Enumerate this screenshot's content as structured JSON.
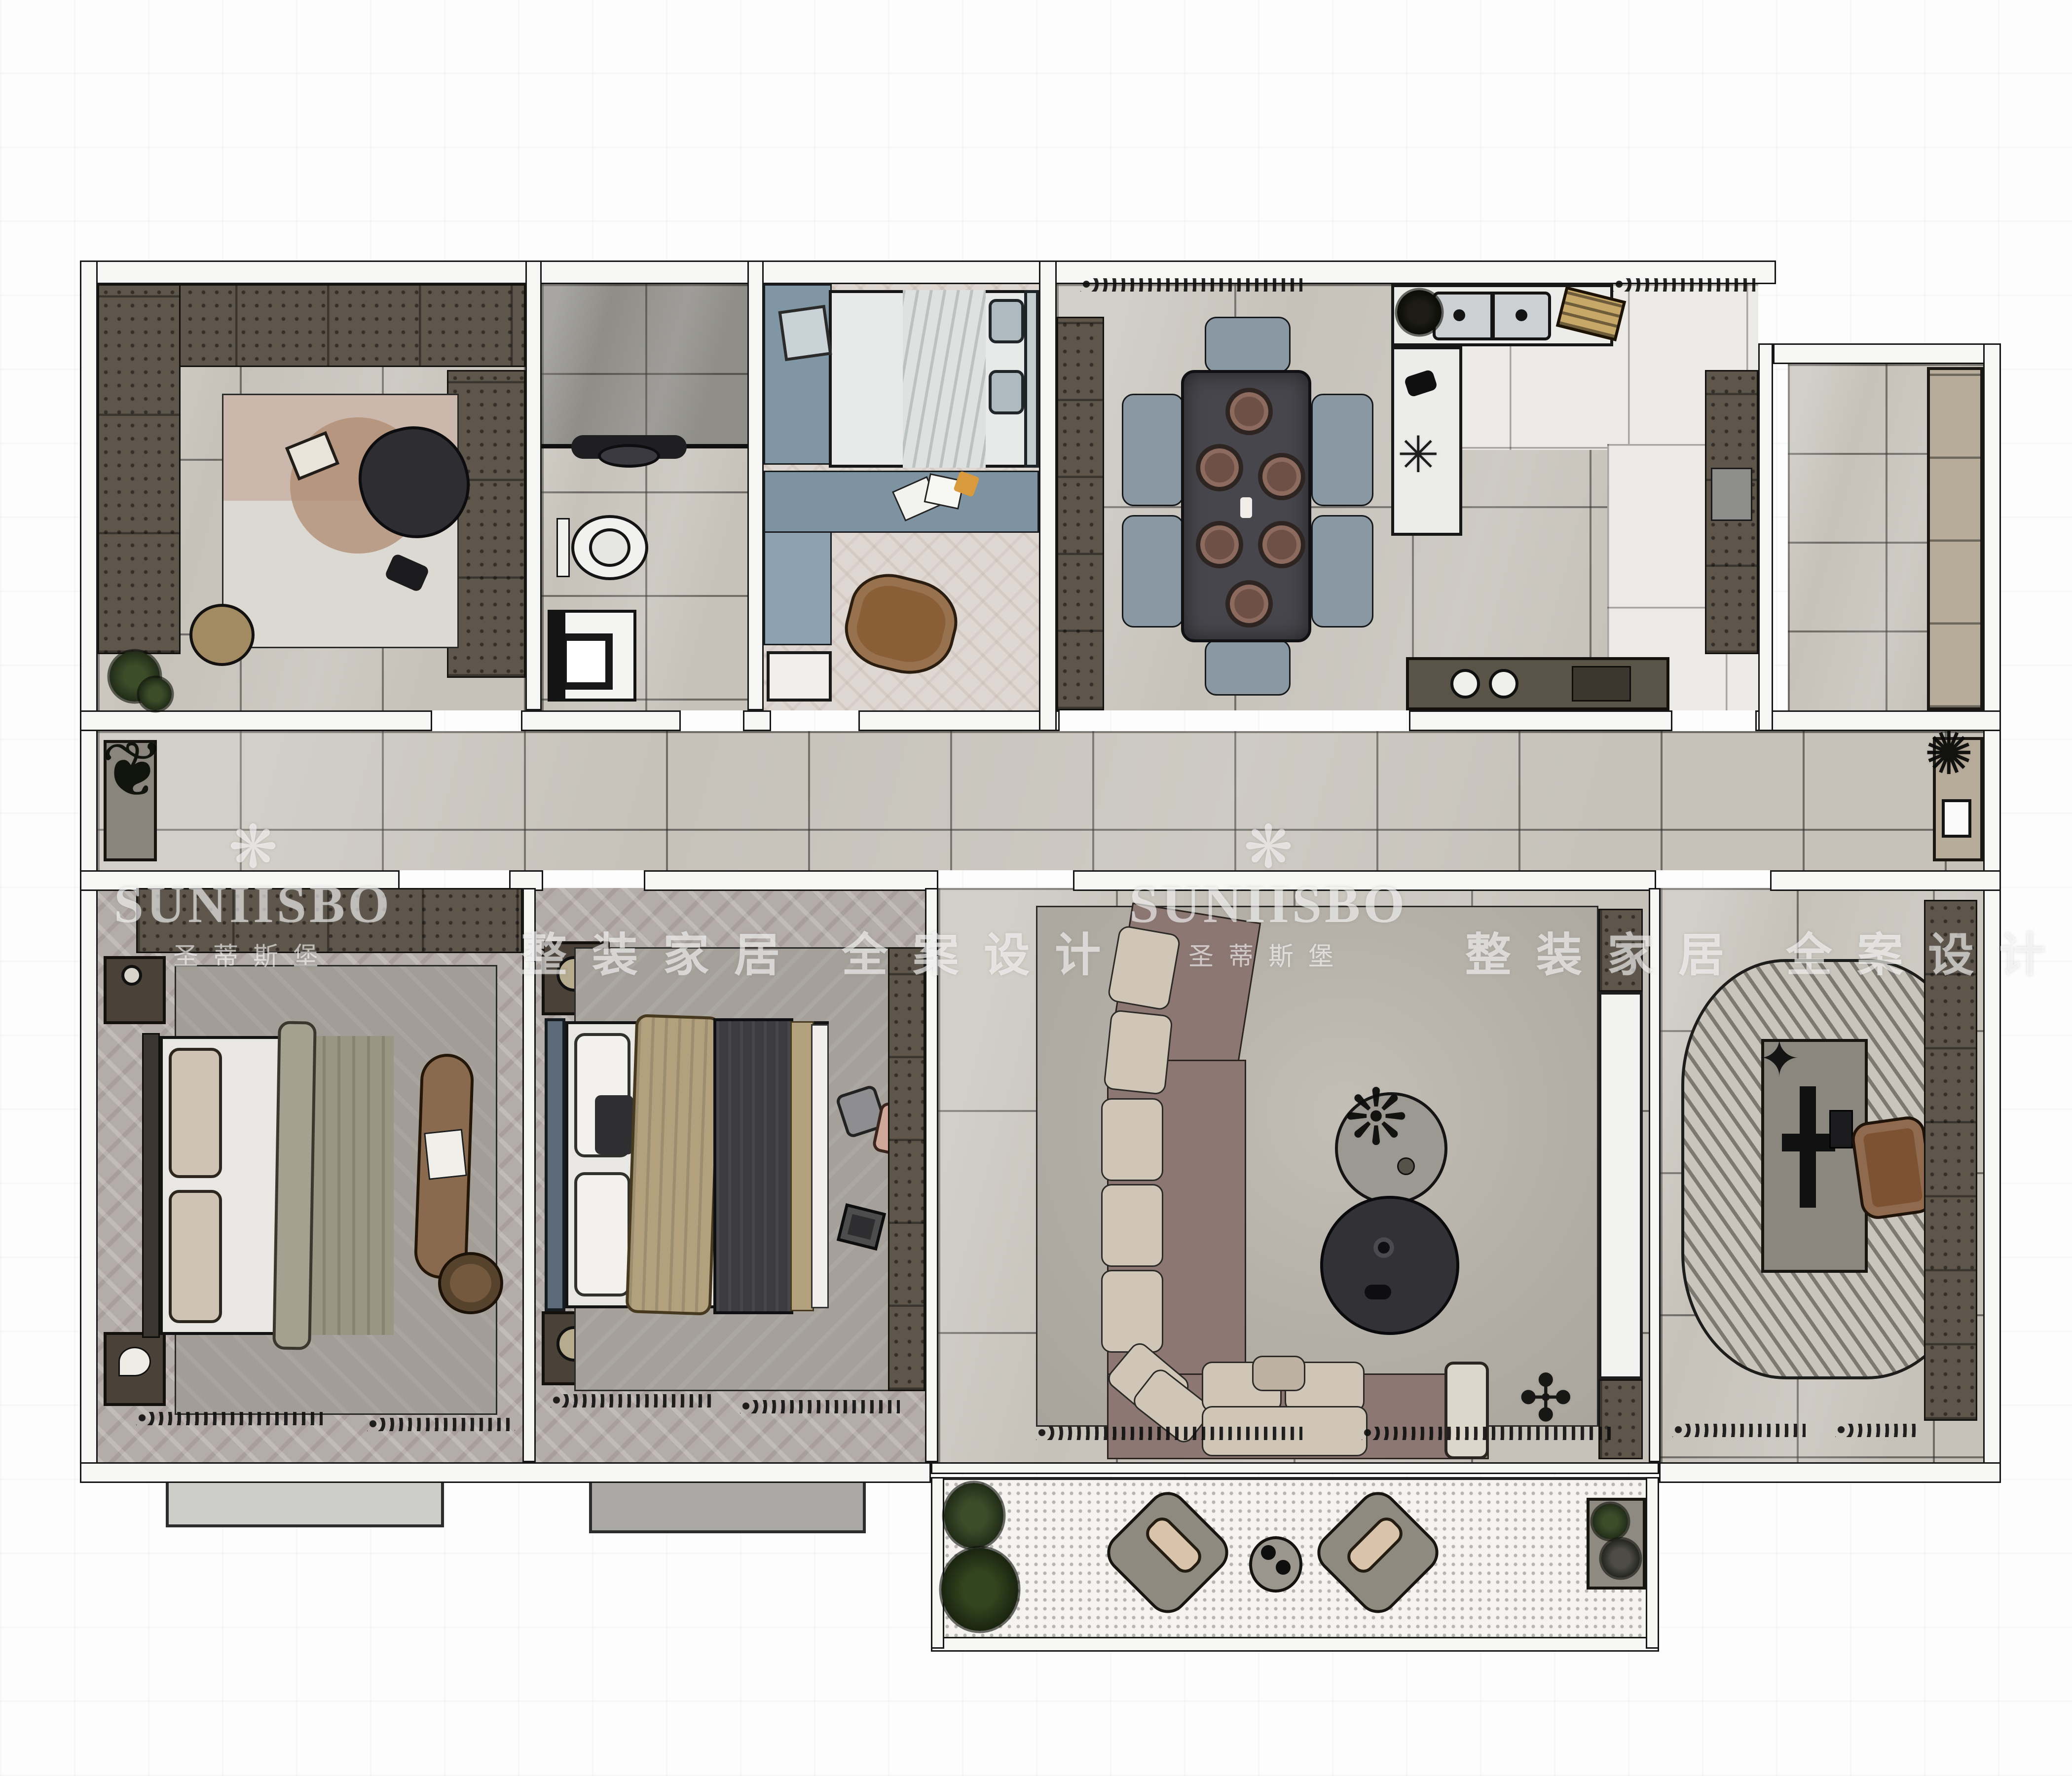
{
  "title": "apartment-floor-plan-rendering",
  "watermarks": {
    "brand_en": "SUNIISBO",
    "brand_cn": "圣蒂斯堡",
    "slogan": "整装家居 全案设计",
    "logo_glyph": "❋"
  },
  "palette": {
    "wall_outline": "#161616",
    "wall_fill": "#f6f6f4",
    "floor_marble": "#c6c2ba",
    "floor_marble_dark": "#8e8d88",
    "floor_chevron": "#b3aca8",
    "floor_wood_light": "#ded7d2",
    "kitchen_floor": "#eceae6",
    "cabinet_brown": "#5e564b",
    "cabinet_blue": "#8096a4",
    "sofa_mauve": "#8c7772",
    "cushion_light": "#cfc6b8",
    "dining_table": "#46464c",
    "chair_gray": "#8a98a3",
    "rug_gray": "#a5a09a",
    "bench_brown": "#8a6a4e",
    "blanket_olive": "#9a9684",
    "blanket_tan": "#b3a17e",
    "blanket_charcoal": "#3c3c3e",
    "balcony_dots": "#f4f3f0",
    "plant_green": "#2e3b22",
    "watermark_white": "rgba(255,255,255,0.6)"
  }
}
